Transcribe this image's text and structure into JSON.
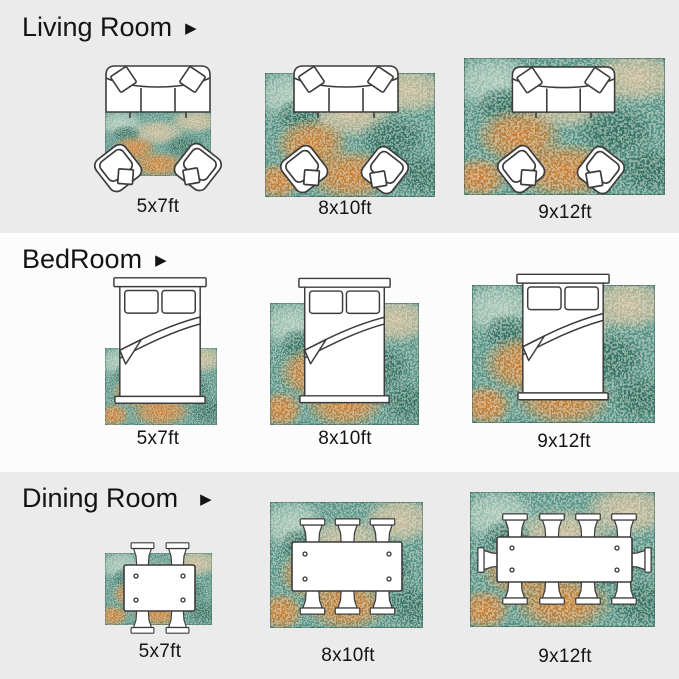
{
  "palette": {
    "section_alt_bg": "#ebebeb",
    "section_main_bg": "#fcfcfc",
    "text": "#141414",
    "line": "#3c3c3c",
    "rug_teal": "#559388",
    "rug_teal_dark": "#2f6e61",
    "rug_orange": "#cf7c2e",
    "rug_beige": "#cbba98",
    "rug_light": "#a8c8bc"
  },
  "icons": {
    "arrow_right": "▶"
  },
  "sections": [
    {
      "title": "Living Room",
      "items": [
        {
          "size": "5x7ft"
        },
        {
          "size": "8x10ft"
        },
        {
          "size": "9x12ft"
        }
      ]
    },
    {
      "title": "BedRoom",
      "items": [
        {
          "size": "5x7ft"
        },
        {
          "size": "8x10ft"
        },
        {
          "size": "9x12ft"
        }
      ]
    },
    {
      "title": "Dining Room",
      "items": [
        {
          "size": "5x7ft"
        },
        {
          "size": "8x10ft"
        },
        {
          "size": "9x12ft"
        }
      ]
    }
  ]
}
